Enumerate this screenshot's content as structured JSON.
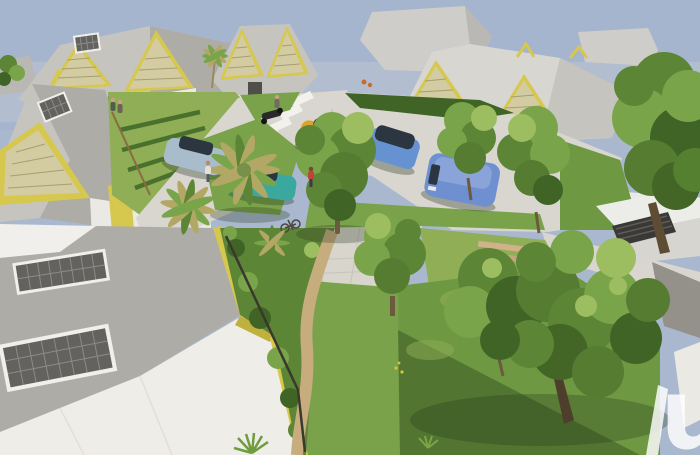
{
  "scene": {
    "kind": "3d-architectural-render",
    "description": "Aerial 3D rendering of a small residential eco-neighborhood: white houses with gray hip roofs, yellow-framed louvered gables and rooftop solar panels line an internal street with parked cars (silver, teal, yellow, blue wagon, blue van), palm trees, dense green trees, hedged gardens and tan walking paths; a large foreground roof with two solar panels occupies the lower left and a partial white letter watermark sits at the lower right edge.",
    "watermark": {
      "glyph": "u"
    }
  },
  "palette": {
    "sky": "#a5b5ce",
    "haze": "#c3c9d3",
    "mass": "#cfcdc9",
    "mass_dark": "#bab8b4",
    "roof_light": "#d8d6d1",
    "roof_mid": "#c6c4bf",
    "roof_dark": "#aeaca7",
    "gable_yellow": "#d6c84e",
    "gable_yellow_deep": "#c0b13e",
    "louver": "#d3cba2",
    "louver_line": "#a89e6e",
    "wall": "#ebe9e4",
    "wall_shade": "#d7d5cf",
    "opening_dark": "#4f4e48",
    "road": "#d9d6cf",
    "road_stripe": "#f2f1ec",
    "plaza": "#d8d5cd",
    "path_tan": "#c7ad7e",
    "grass_bright": "#8fae56",
    "grass": "#79a24a",
    "lawn": "#6f9843",
    "green_dark": "#3f6426",
    "green_mid": "#5d8536",
    "green_light": "#79a44a",
    "green_pale": "#9cbd60",
    "frond_tan": "#b2a764",
    "trunk": "#6b5a3e",
    "panel_dark": "#63625e",
    "panel_frame": "#f0efec",
    "car_silver": "#a9bccb",
    "car_teal": "#3ba8a0",
    "car_yellow": "#dfa22b",
    "car_blue": "#6792d2",
    "van_blue": "#6e8fd0",
    "van_roof": "#8aa4da",
    "glass_dark": "#2b3641",
    "shadow_green": "#2f3c26",
    "watermark": "rgba(255,255,255,0.82)"
  }
}
